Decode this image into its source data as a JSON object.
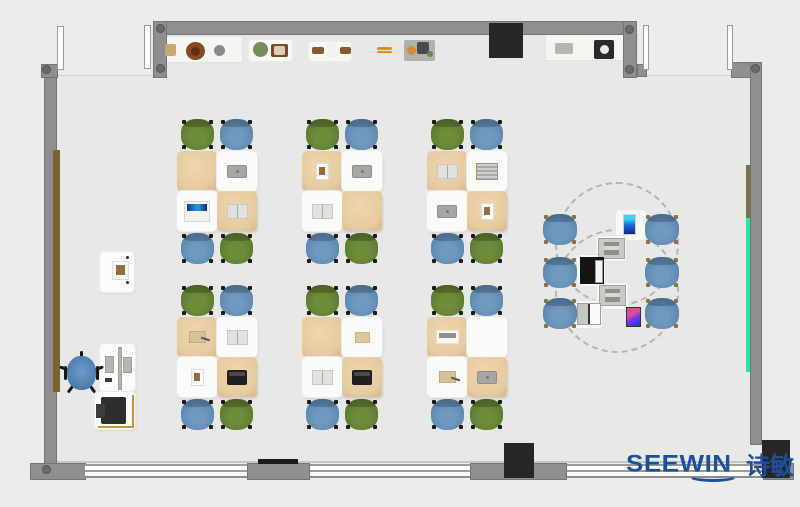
{
  "brand": {
    "text": "SEEWIN",
    "cjk": "诗敏",
    "color": "#1d4f9f"
  },
  "palette": {
    "exterior": "#ececec",
    "floor": "#e8e8e6",
    "wall": "#8f8f8f",
    "wallDark": "#757575",
    "window": "#ffffff",
    "black": "#262626",
    "tanDesk": "#e7cba2",
    "whiteDesk": "#fafaf9",
    "greenChair": "#5e7d30",
    "blueChair": "#5e8ab2",
    "teacherChair": "#4d7fae",
    "accentGreenStrip": "#2fe3a3",
    "doorBrown": "#7a6234",
    "logoBlue": "#1d4f9f"
  },
  "structure": [
    {
      "n": "room-floor",
      "cls": "floor",
      "x": 57,
      "y": 35,
      "w": 693,
      "h": 428
    },
    {
      "n": "entry-opening-left",
      "cls": "ext-patch",
      "x": 57,
      "y": 35,
      "w": 96,
      "h": 41
    },
    {
      "n": "entry-opening-right",
      "cls": "ext-patch",
      "x": 637,
      "y": 35,
      "w": 113,
      "h": 41
    },
    {
      "n": "floor-edge-line",
      "cls": "floorline",
      "x": 57,
      "y": 461,
      "w": 706,
      "h": 2
    },
    {
      "n": "counter-shelf-left",
      "cls": "shelf",
      "x": 157,
      "y": 36,
      "w": 86,
      "h": 27
    },
    {
      "n": "shelf-pad-1",
      "cls": "pad",
      "x": 249,
      "y": 40,
      "w": 43,
      "h": 21
    },
    {
      "n": "shelf-pad-2",
      "cls": "pad",
      "x": 309,
      "y": 42,
      "w": 42,
      "h": 19
    },
    {
      "n": "counter-shelf-right",
      "cls": "shelf",
      "x": 545,
      "y": 33,
      "w": 93,
      "h": 28
    },
    {
      "n": "whiteboard",
      "cls": "board",
      "x": 247,
      "y": 21,
      "w": 168,
      "h": 11
    },
    {
      "n": "wall-top",
      "cls": "wall",
      "x": 153,
      "y": 21,
      "w": 484,
      "h": 14
    },
    {
      "n": "wall-top-left-stub",
      "cls": "wall",
      "x": 153,
      "y": 21,
      "w": 14,
      "h": 57
    },
    {
      "n": "wall-top-right-stub",
      "cls": "wall",
      "x": 623,
      "y": 21,
      "w": 14,
      "h": 57
    },
    {
      "n": "wall-stub-foot",
      "cls": "wall",
      "x": 637,
      "y": 64,
      "w": 10,
      "h": 13
    },
    {
      "n": "wall-top-right-segment",
      "cls": "wall",
      "x": 731,
      "y": 62,
      "w": 31,
      "h": 16
    },
    {
      "n": "wall-right",
      "cls": "wall",
      "x": 750,
      "y": 62,
      "w": 12,
      "h": 383
    },
    {
      "n": "wall-left",
      "cls": "wall",
      "x": 44,
      "y": 64,
      "w": 13,
      "h": 400
    },
    {
      "n": "wall-left-corner-top",
      "cls": "wall",
      "x": 41,
      "y": 64,
      "w": 17,
      "h": 14
    },
    {
      "n": "wall-bottom-left-corner",
      "cls": "wall",
      "x": 30,
      "y": 463,
      "w": 56,
      "h": 17
    },
    {
      "n": "wall-bottom-pier-1",
      "cls": "wall",
      "x": 247,
      "y": 463,
      "w": 63,
      "h": 17
    },
    {
      "n": "wall-bottom-pier-2",
      "cls": "wall",
      "x": 470,
      "y": 463,
      "w": 97,
      "h": 17
    },
    {
      "n": "wall-bottom-right",
      "cls": "wall",
      "x": 763,
      "y": 463,
      "w": 31,
      "h": 17
    },
    {
      "n": "window-band-1",
      "cls": "win",
      "x": 85,
      "y": 464,
      "w": 162,
      "h": 14
    },
    {
      "n": "window-band-2",
      "cls": "win",
      "x": 310,
      "y": 464,
      "w": 160,
      "h": 14
    },
    {
      "n": "window-band-3",
      "cls": "win",
      "x": 567,
      "y": 464,
      "w": 196,
      "h": 14
    },
    {
      "n": "radiator-bar",
      "cls": "blackbar",
      "x": 258,
      "y": 459,
      "w": 40,
      "h": 5
    },
    {
      "n": "bottom-column",
      "cls": "blackBlock",
      "x": 504,
      "y": 443,
      "w": 30,
      "h": 35
    },
    {
      "n": "top-cabinet",
      "cls": "blackBlock",
      "x": 489,
      "y": 23,
      "w": 34,
      "h": 35
    },
    {
      "n": "bottom-right-block",
      "cls": "blackBlock",
      "x": 762,
      "y": 440,
      "w": 28,
      "h": 38
    },
    {
      "n": "door-leaf-frame-1",
      "cls": "doorframe",
      "x": 57,
      "y": 26,
      "w": 7,
      "h": 44
    },
    {
      "n": "door-leaf-frame-2",
      "cls": "doorframe",
      "x": 144,
      "y": 25,
      "w": 7,
      "h": 44
    },
    {
      "n": "door-leaf-frame-3",
      "cls": "doorframe",
      "x": 643,
      "y": 25,
      "w": 6,
      "h": 45
    },
    {
      "n": "door-leaf-frame-4",
      "cls": "doorframe",
      "x": 727,
      "y": 25,
      "w": 6,
      "h": 45
    },
    {
      "n": "left-wall-wood-panel",
      "cls": "browndoor",
      "x": 53,
      "y": 150,
      "w": 7,
      "h": 242
    },
    {
      "n": "right-wall-olive-panel",
      "cls": "olivestrip",
      "x": 746,
      "y": 165,
      "w": 5,
      "h": 53
    },
    {
      "n": "right-wall-green-strip",
      "cls": "greenstrip",
      "x": 746,
      "y": 218,
      "w": 4,
      "h": 154
    }
  ],
  "dots": [
    {
      "x": 160,
      "y": 28
    },
    {
      "x": 160,
      "y": 68
    },
    {
      "x": 629,
      "y": 29
    },
    {
      "x": 629,
      "y": 69
    },
    {
      "x": 755,
      "y": 68
    },
    {
      "x": 46,
      "y": 69
    },
    {
      "x": 46,
      "y": 469
    }
  ],
  "shelfItems": [
    {
      "n": "shelf-box-tan",
      "x": 165,
      "y": 44,
      "w": 11,
      "h": 12,
      "c": "#c9a96f",
      "shape": "rect"
    },
    {
      "n": "shelf-plate-brown",
      "x": 186,
      "y": 42,
      "w": 19,
      "h": 18,
      "c": "#8a4a1f",
      "shape": "circle"
    },
    {
      "n": "shelf-plate-center",
      "x": 191,
      "y": 47,
      "w": 9,
      "h": 9,
      "c": "#5e2f12",
      "shape": "circle"
    },
    {
      "n": "shelf-disc-gray",
      "x": 214,
      "y": 45,
      "w": 11,
      "h": 11,
      "c": "#8a8a8a",
      "shape": "circle"
    },
    {
      "n": "shelf-plant-green",
      "x": 253,
      "y": 42,
      "w": 15,
      "h": 15,
      "c": "#7a8a5a",
      "shape": "circle"
    },
    {
      "n": "shelf-picture-frame",
      "x": 271,
      "y": 44,
      "w": 17,
      "h": 13,
      "c": "#7a4a28",
      "shape": "rect"
    },
    {
      "n": "shelf-frame-photo",
      "x": 274,
      "y": 46,
      "w": 11,
      "h": 9,
      "c": "#d8cfc2",
      "shape": "rect"
    },
    {
      "n": "shelf-stick-left",
      "x": 312,
      "y": 47,
      "w": 12,
      "h": 7,
      "c": "#8a5a2e",
      "shape": "rect"
    },
    {
      "n": "shelf-box-white",
      "x": 326,
      "y": 43,
      "w": 13,
      "h": 14,
      "c": "#f2f2ef",
      "shape": "rect"
    },
    {
      "n": "shelf-stick-right",
      "x": 340,
      "y": 47,
      "w": 11,
      "h": 7,
      "c": "#8a5a2e",
      "shape": "rect"
    },
    {
      "n": "shelf-ruler-orange-1",
      "x": 377,
      "y": 47,
      "w": 15,
      "h": 3,
      "c": "#e08a2e",
      "shape": "rect"
    },
    {
      "n": "shelf-ruler-orange-2",
      "x": 377,
      "y": 51,
      "w": 15,
      "h": 2,
      "c": "#e08a2e",
      "shape": "rect"
    },
    {
      "n": "shelf-tray",
      "x": 404,
      "y": 40,
      "w": 31,
      "h": 21,
      "c": "#b0b0ae",
      "shape": "rect"
    },
    {
      "n": "tray-ball-orange",
      "x": 407,
      "y": 46,
      "w": 9,
      "h": 9,
      "c": "#d88a2e",
      "shape": "circle"
    },
    {
      "n": "tray-gadget-dark",
      "x": 417,
      "y": 42,
      "w": 12,
      "h": 12,
      "c": "#4a4a48",
      "shape": "rect"
    },
    {
      "n": "tray-bit-green",
      "x": 427,
      "y": 51,
      "w": 6,
      "h": 6,
      "c": "#6a8a4a",
      "shape": "circle"
    },
    {
      "n": "rightshelf-box-gray",
      "x": 555,
      "y": 43,
      "w": 18,
      "h": 11,
      "c": "#b5b5b2",
      "shape": "rect"
    },
    {
      "n": "rightshelf-device-dark",
      "x": 594,
      "y": 40,
      "w": 20,
      "h": 19,
      "c": "#2a2a2a",
      "shape": "rect"
    },
    {
      "n": "rightshelf-device-dial",
      "x": 600,
      "y": 45,
      "w": 9,
      "h": 9,
      "c": "#e8e8e6",
      "shape": "circle"
    }
  ],
  "clusterTemplate": {
    "w": 80,
    "h": 145,
    "chairSize": [
      33,
      31
    ],
    "deskSize": [
      40,
      40
    ],
    "chairs": [
      {
        "dx": 4,
        "dy": 0,
        "color": "green"
      },
      {
        "dx": 43,
        "dy": 0,
        "color": "blue"
      },
      {
        "dx": 4,
        "dy": 114,
        "color": "blue"
      },
      {
        "dx": 43,
        "dy": 114,
        "color": "green"
      }
    ],
    "desks": [
      {
        "dx": 0,
        "dy": 32,
        "type": "tan"
      },
      {
        "dx": 40,
        "dy": 32,
        "type": "white"
      },
      {
        "dx": 0,
        "dy": 72,
        "type": "white"
      },
      {
        "dx": 40,
        "dy": 72,
        "type": "tan"
      }
    ]
  },
  "itemKinds": {
    "tablet": [
      20,
      13
    ],
    "laptopBlue": [
      26,
      21
    ],
    "bookOpen": [
      21,
      15
    ],
    "photo": [
      13,
      17
    ],
    "laptopBlack": [
      20,
      15
    ],
    "paperTan": [
      15,
      11
    ],
    "keyboard": [
      23,
      14
    ],
    "bookTan": [
      17,
      12
    ],
    "stripedBook": [
      22,
      17
    ],
    "tabletBlue": [
      13,
      21
    ],
    "grayDev": [
      27,
      21
    ],
    "blackLaptop": [
      24,
      27
    ],
    "smallLaptop": [
      24,
      22
    ],
    "tabletColor": [
      15,
      20
    ]
  },
  "clusters": [
    {
      "x": 177,
      "y": 119,
      "items": [
        {
          "slot": 1,
          "kind": "tablet"
        },
        {
          "slot": 2,
          "kind": "laptopBlue"
        },
        {
          "slot": 3,
          "kind": "bookOpen"
        }
      ]
    },
    {
      "x": 302,
      "y": 119,
      "items": [
        {
          "slot": 0,
          "kind": "photo"
        },
        {
          "slot": 1,
          "kind": "tablet"
        },
        {
          "slot": 2,
          "kind": "bookOpen"
        }
      ]
    },
    {
      "x": 427,
      "y": 119,
      "items": [
        {
          "slot": 0,
          "kind": "bookOpen"
        },
        {
          "slot": 1,
          "kind": "stripedBook"
        },
        {
          "slot": 2,
          "kind": "tablet"
        },
        {
          "slot": 3,
          "kind": "photo"
        }
      ]
    },
    {
      "x": 177,
      "y": 285,
      "items": [
        {
          "slot": 0,
          "kind": "bookTan"
        },
        {
          "slot": 1,
          "kind": "bookOpen"
        },
        {
          "slot": 2,
          "kind": "photo"
        },
        {
          "slot": 3,
          "kind": "laptopBlack"
        }
      ]
    },
    {
      "x": 302,
      "y": 285,
      "items": [
        {
          "slot": 1,
          "kind": "paperTan"
        },
        {
          "slot": 2,
          "kind": "bookOpen"
        },
        {
          "slot": 3,
          "kind": "laptopBlack"
        }
      ]
    },
    {
      "x": 427,
      "y": 285,
      "items": [
        {
          "slot": 0,
          "kind": "keyboard"
        },
        {
          "slot": 2,
          "kind": "bookTan"
        },
        {
          "slot": 3,
          "kind": "tablet"
        }
      ]
    }
  ],
  "collab": {
    "circles": [
      {
        "x": 555,
        "y": 182,
        "d": 124
      },
      {
        "x": 555,
        "y": 229,
        "d": 124
      }
    ],
    "chairSize": [
      34,
      31
    ],
    "chairs": [
      [
        543,
        214
      ],
      [
        543,
        257
      ],
      [
        543,
        298
      ],
      [
        645,
        214
      ],
      [
        645,
        257
      ],
      [
        645,
        298
      ]
    ],
    "tables": [
      [
        616,
        210,
        30,
        30
      ],
      [
        596,
        236,
        30,
        25
      ],
      [
        577,
        255,
        28,
        31
      ],
      [
        597,
        283,
        31,
        26
      ],
      [
        574,
        301,
        28,
        27
      ]
    ],
    "devices": [
      {
        "kind": "tabletBlue",
        "x": 623,
        "y": 214
      },
      {
        "kind": "grayDev",
        "x": 598,
        "y": 238
      },
      {
        "kind": "blackLaptop",
        "x": 580,
        "y": 257
      },
      {
        "kind": "grayDev",
        "x": 599,
        "y": 285
      },
      {
        "kind": "smallLaptop",
        "x": 577,
        "y": 303
      },
      {
        "kind": "tabletColor",
        "x": 626,
        "y": 307
      }
    ]
  },
  "teacher": {
    "parts": [
      {
        "n": "lectern",
        "cls": "tdesk",
        "x": 100,
        "y": 252,
        "w": 34,
        "h": 40
      },
      {
        "n": "lectern-book",
        "cls": "item it-photo",
        "x": 112,
        "y": 261,
        "w": 17,
        "h": 19
      },
      {
        "n": "lectern-dot",
        "cls": "tinydot",
        "x": 126,
        "y": 256,
        "w": 3,
        "h": 3
      },
      {
        "n": "lectern-dot",
        "cls": "tinydot",
        "x": 126,
        "y": 281,
        "w": 3,
        "h": 3
      },
      {
        "n": "teacher-desk",
        "cls": "tdesk",
        "x": 100,
        "y": 344,
        "w": 35,
        "h": 47
      },
      {
        "n": "desk-divider",
        "cls": "graybar",
        "x": 118,
        "y": 347,
        "w": 4,
        "h": 43
      },
      {
        "n": "teacher-monitor",
        "cls": "graybar",
        "x": 105,
        "y": 356,
        "w": 9,
        "h": 17
      },
      {
        "n": "teacher-monitor",
        "cls": "graybar",
        "x": 123,
        "y": 357,
        "w": 9,
        "h": 16
      },
      {
        "n": "teacher-desk-item",
        "cls": "printer2",
        "x": 105,
        "y": 378,
        "w": 7,
        "h": 4
      },
      {
        "n": "printer-stand",
        "cls": "tdesk",
        "x": 95,
        "y": 392,
        "w": 40,
        "h": 37
      },
      {
        "n": "printer-outline-right",
        "cls": "tanline",
        "x": 132,
        "y": 395,
        "w": 2,
        "h": 33
      },
      {
        "n": "printer-outline-bottom",
        "cls": "tanline",
        "x": 98,
        "y": 426,
        "w": 36,
        "h": 2
      },
      {
        "n": "printer-body",
        "cls": "printer",
        "x": 101,
        "y": 397,
        "w": 25,
        "h": 27
      },
      {
        "n": "printer-tray",
        "cls": "printer2",
        "x": 96,
        "y": 404,
        "w": 9,
        "h": 14
      }
    ],
    "chair": {
      "x": 62,
      "y": 351,
      "w": 38,
      "h": 46,
      "seat": [
        67,
        356,
        29,
        34
      ]
    }
  }
}
